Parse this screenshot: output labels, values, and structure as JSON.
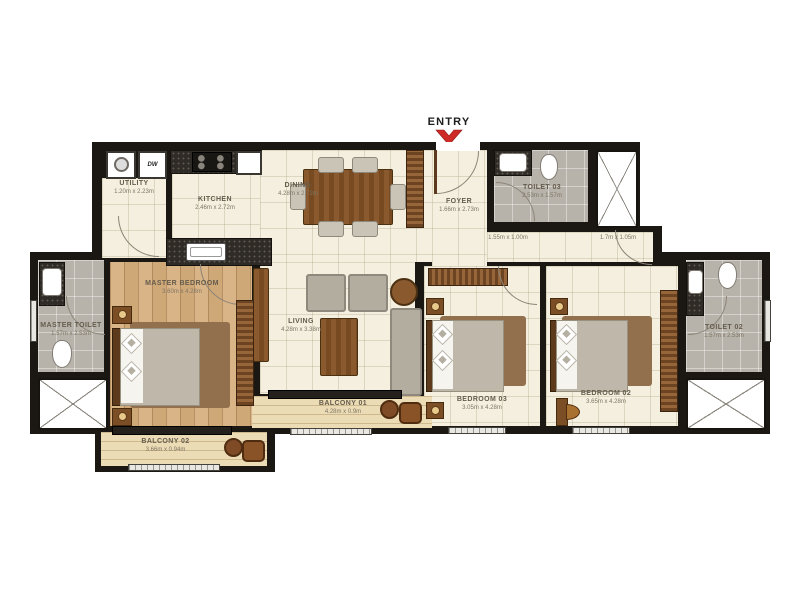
{
  "entry": {
    "label": "ENTRY"
  },
  "appliances": {
    "dishwasher_label": "DW"
  },
  "rooms": {
    "utility": {
      "name": "UTILITY",
      "dims": "1.20m x 2.23m"
    },
    "kitchen": {
      "name": "KITCHEN",
      "dims": "2.46m x 2.72m"
    },
    "dining": {
      "name": "DINING",
      "dims": "4.28m x 2.72m"
    },
    "foyer": {
      "name": "FOYER",
      "dims": "1.66m x 2.73m"
    },
    "toilet03": {
      "name": "TOILET 03",
      "dims": "2.53m x 1.57m"
    },
    "master_toilet": {
      "name": "MASTER TOILET",
      "dims": "1.57m x 2.53m"
    },
    "master_bedroom": {
      "name": "MASTER BEDROOM",
      "dims": "3.60m x 4.28m"
    },
    "living": {
      "name": "LIVING",
      "dims": "4.28m x 3.38m"
    },
    "balcony01": {
      "name": "BALCONY 01",
      "dims": "4.28m x 0.9m"
    },
    "balcony02": {
      "name": "BALCONY 02",
      "dims": "3.66m x 0.94m"
    },
    "bedroom03": {
      "name": "BEDROOM 03",
      "dims": "3.05m x 4.28m"
    },
    "bedroom02": {
      "name": "BEDROOM 02",
      "dims": "3.65m x 4.28m"
    },
    "toilet02": {
      "name": "TOILET 02",
      "dims": "1.57m x 2.53m"
    }
  },
  "passages": {
    "p1": "1.55m x 1.00m",
    "p2": "1.7m x 1.05m"
  },
  "colors": {
    "wall": "#1b1713",
    "floor_cream": "#f4efdf",
    "floor_wood": "#d5ad7f",
    "floor_tile": "#b7b2aa",
    "floor_balcony": "#ecdcb6",
    "accent_red": "#cf2b26",
    "furniture_wood": "#8a5a2e"
  }
}
